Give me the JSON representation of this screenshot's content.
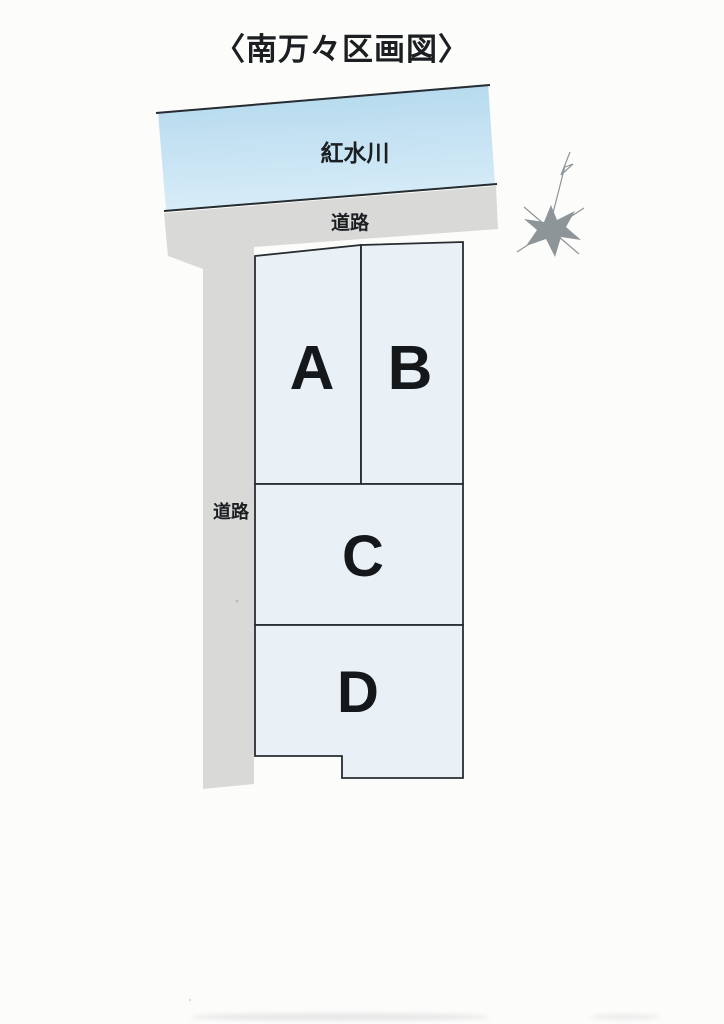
{
  "title": "〈南万々区画図〉",
  "map": {
    "river": {
      "label": "紅水川"
    },
    "road_top": {
      "label": "道路"
    },
    "road_left": {
      "label": "道路"
    },
    "parcels": [
      {
        "label": "A"
      },
      {
        "label": "B"
      },
      {
        "label": "C"
      },
      {
        "label": "D"
      }
    ],
    "north_mark_icon": "hand-drawn-star-with-pennant"
  },
  "colors": {
    "paper": "#fcfcfb",
    "river_top": "#b2d8ed",
    "river_bottom": "#d7ecf8",
    "road": "#d9dad8",
    "parcel_fill": "#e9f0f6",
    "line": "#262c30",
    "text": "#1c1f22",
    "compass": "#8e9598"
  }
}
